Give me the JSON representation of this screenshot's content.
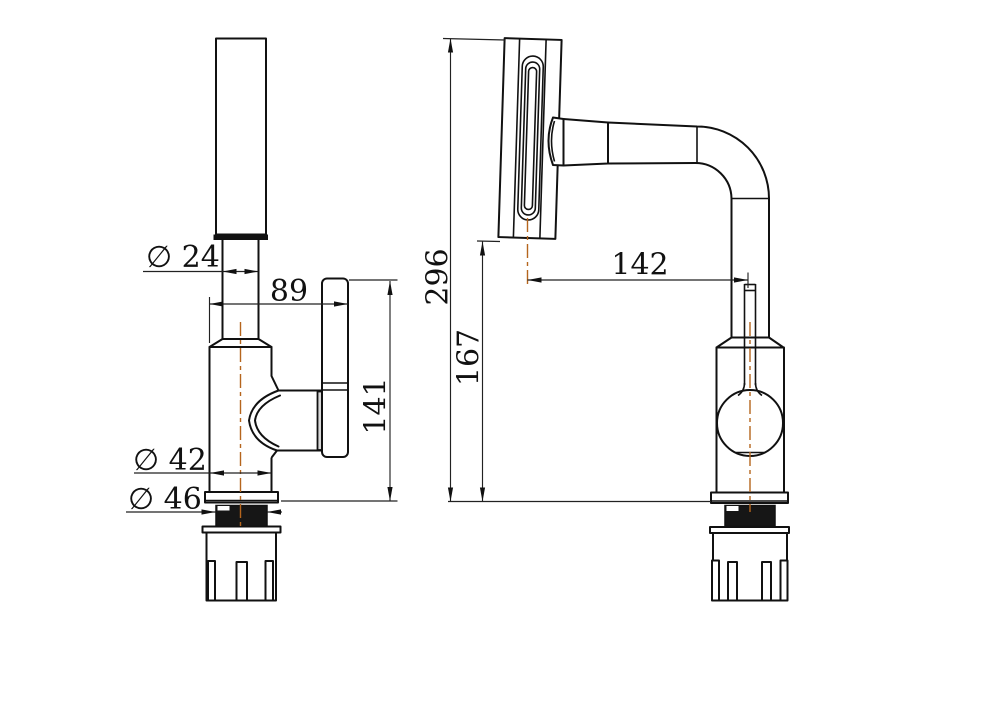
{
  "meta": {
    "title": "Faucet dimensional drawing (two orthographic views)",
    "canvas": {
      "width": 1000,
      "height": 707
    },
    "colors": {
      "background": "#ffffff",
      "line": "#111111",
      "centerline": "#b5651d"
    }
  },
  "views": {
    "front": {
      "name": "front view"
    },
    "side": {
      "name": "side view"
    }
  },
  "dims": {
    "spout_diameter": {
      "label": "∅ 24",
      "value": 24,
      "view": "front"
    },
    "handle_reach": {
      "label": "89",
      "value": 89,
      "view": "front"
    },
    "front_height": {
      "label": "141",
      "value": 141,
      "view": "front"
    },
    "body_diameter": {
      "label": "∅ 42",
      "value": 42,
      "view": "front"
    },
    "thread_diameter": {
      "label": "∅ 46",
      "value": 46,
      "view": "front"
    },
    "overall_height": {
      "label": "296",
      "value": 296,
      "view": "side"
    },
    "outlet_height": {
      "label": "167",
      "value": 167,
      "view": "side"
    },
    "spout_reach": {
      "label": "142",
      "value": 142,
      "view": "side"
    }
  }
}
